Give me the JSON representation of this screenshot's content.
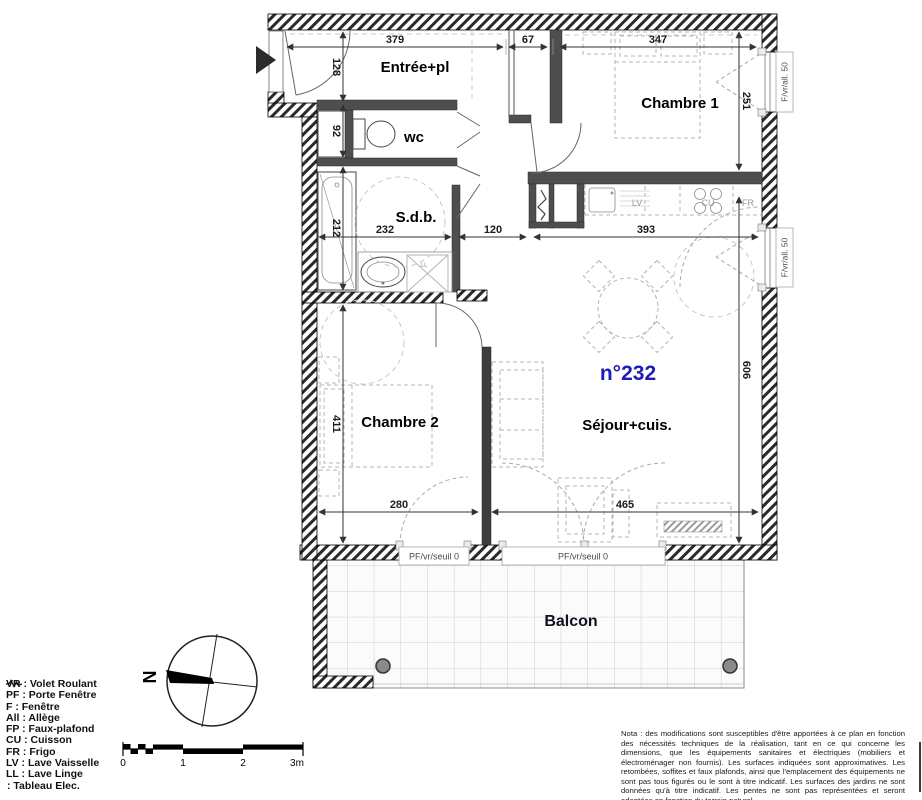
{
  "plan": {
    "unit_number": "n°232",
    "rooms": {
      "entree": "Entrée+pl",
      "wc": "wc",
      "sdb": "S.d.b.",
      "chambre1": "Chambre 1",
      "chambre2": "Chambre 2",
      "sejour": "Séjour+cuis.",
      "balcon": "Balcon"
    },
    "dims": {
      "d379": "379",
      "d67": "67",
      "d347": "347",
      "d128": "128",
      "d92": "92",
      "d212": "212",
      "d411": "411",
      "d232": "232",
      "d120": "120",
      "d393": "393",
      "d280": "280",
      "d465": "465",
      "d251": "251",
      "d606": "606"
    },
    "appliances": {
      "lv": "LV",
      "cu": "CU",
      "fr": "FR",
      "ll": "LL"
    },
    "windows": [
      "F/vr/all. 50",
      "F/vr/all. 50"
    ],
    "doors": [
      "PF/vr/seuil 0",
      "PF/vr/seuil 0"
    ]
  },
  "legend": {
    "items": [
      "VR : Volet Roulant",
      "PF : Porte Fenêtre",
      "F : Fenêtre",
      "All : Allège",
      "FP : Faux-plafond",
      "CU : Cuisson",
      "FR : Frigo",
      "LV : Lave Vaisselle",
      "LL : Lave Linge"
    ],
    "tableau_label": ": Tableau Elec."
  },
  "compass": {
    "north": "N"
  },
  "scalebar": {
    "ticks": [
      "0",
      "1",
      "2",
      "3m"
    ]
  },
  "nota": {
    "text": "Nota : des modifications sont susceptibles d'être apportées à ce plan en fonction des nécessités techniques de la réalisation, tant en ce qui concerne les dimensions, que les équipements sanitaires et électriques (mobiliers et électroménager non fournis). Les surfaces indiquées sont approximatives. Les retombées, soffites et faux plafonds, ainsi que l'emplacement des équipements ne sont pas tous figurés ou le sont à titre indicatif. Les surfaces des jardins ne sont données qu'à titre indicatif. Les pentes ne sont pas représentées et seront adaptées en fonction du terrain naturel."
  },
  "colors": {
    "unit_number_blue": "#1d1db5",
    "wall_black": "#111111"
  }
}
